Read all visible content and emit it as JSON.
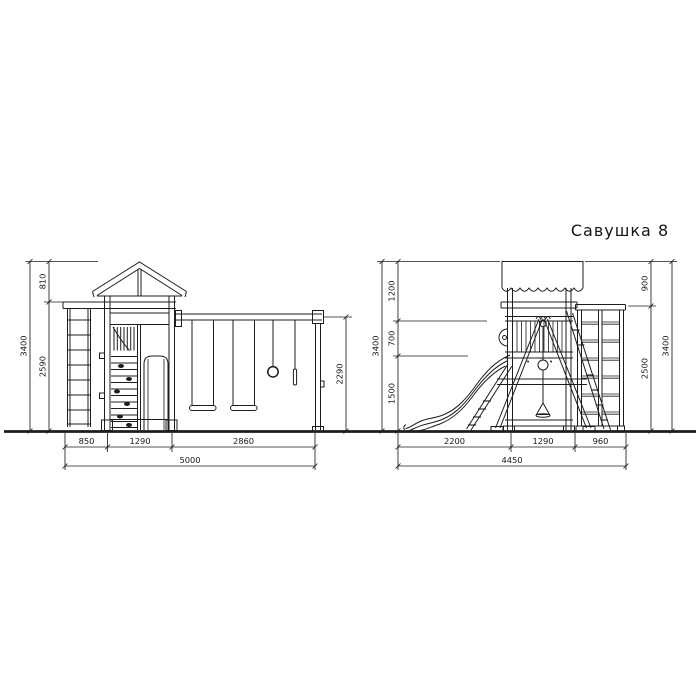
{
  "title": "Савушка 8",
  "colors": {
    "line": "#1d1d1d",
    "background": "#ffffff"
  },
  "views": {
    "front": {
      "label": "front view",
      "dims": {
        "roof_height": "810",
        "body_height": "2590",
        "total_height": "3400",
        "swing_beam_height": "2290",
        "ladder_span": "850",
        "tower_span": "1290",
        "swing_span": "2860",
        "total_span": "5000"
      }
    },
    "side": {
      "label": "side view",
      "dims": {
        "canopy_drop": "1200",
        "railing_drop": "700",
        "deck_height": "1500",
        "total_height": "3400",
        "canopy_clearance": "900",
        "climb_wall_height": "2500",
        "total_height_right": "3400",
        "slide_span": "2200",
        "tower_span": "1290",
        "climb_wall_span": "960",
        "total_span": "4450"
      }
    }
  }
}
